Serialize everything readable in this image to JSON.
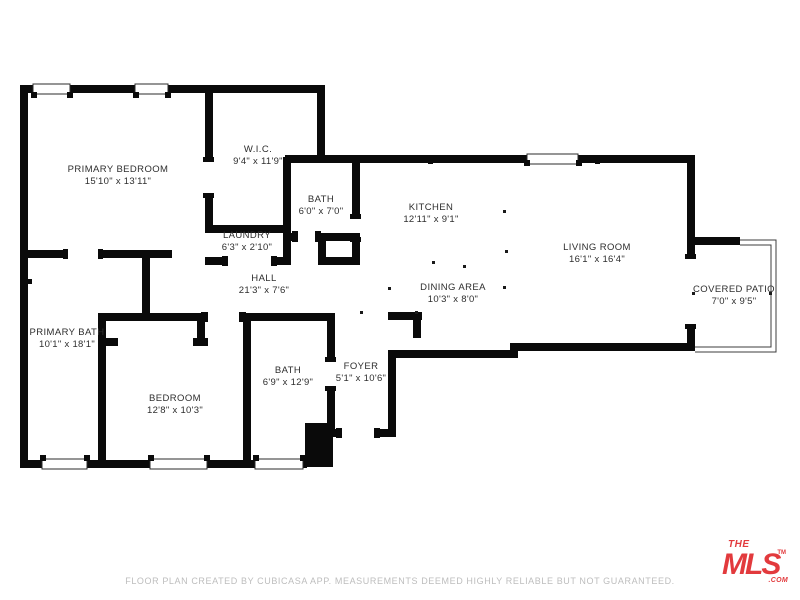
{
  "floor_plan": {
    "colors": {
      "walls": "#0a0a0a",
      "logo_red": "#e23a3d",
      "footer_gray": "#bdbdbd",
      "label_text": "#2e2e2e"
    },
    "rooms": [
      {
        "name": "PRIMARY BEDROOM",
        "dimensions": "15'10\" x 13'11\"",
        "cx": 118,
        "cy": 176
      },
      {
        "name": "W.I.C.",
        "dimensions": "9'4\" x 11'9\"",
        "cx": 258,
        "cy": 156
      },
      {
        "name": "BATH",
        "dimensions": "6'0\" x 7'0\"",
        "cx": 321,
        "cy": 206
      },
      {
        "name": "KITCHEN",
        "dimensions": "12'11\" x 9'1\"",
        "cx": 431,
        "cy": 214
      },
      {
        "name": "LIVING ROOM",
        "dimensions": "16'1\" x 16'4\"",
        "cx": 597,
        "cy": 254
      },
      {
        "name": "LAUNDRY",
        "dimensions": "6'3\" x 2'10\"",
        "cx": 247,
        "cy": 242
      },
      {
        "name": "HALL",
        "dimensions": "21'3\" x 7'6\"",
        "cx": 264,
        "cy": 285
      },
      {
        "name": "DINING AREA",
        "dimensions": "10'3\" x 8'0\"",
        "cx": 453,
        "cy": 294
      },
      {
        "name": "COVERED PATIO",
        "dimensions": "7'0\" x 9'5\"",
        "cx": 734,
        "cy": 296
      },
      {
        "name": "PRIMARY BATH",
        "dimensions": "10'1\" x 18'1\"",
        "cx": 67,
        "cy": 339
      },
      {
        "name": "BEDROOM",
        "dimensions": "12'8\" x 10'3\"",
        "cx": 175,
        "cy": 405
      },
      {
        "name": "BATH",
        "dimensions": "6'9\" x 12'9\"",
        "cx": 288,
        "cy": 377
      },
      {
        "name": "FOYER",
        "dimensions": "5'1\" x 10'6\"",
        "cx": 361,
        "cy": 373
      }
    ],
    "footer": "FLOOR PLAN CREATED BY CUBICASA APP. MEASUREMENTS DEEMED HIGHLY RELIABLE BUT NOT GUARANTEED.",
    "logo": {
      "the": "THE",
      "mls": "MLS",
      "tm": "TM",
      "com": ".COM"
    }
  }
}
